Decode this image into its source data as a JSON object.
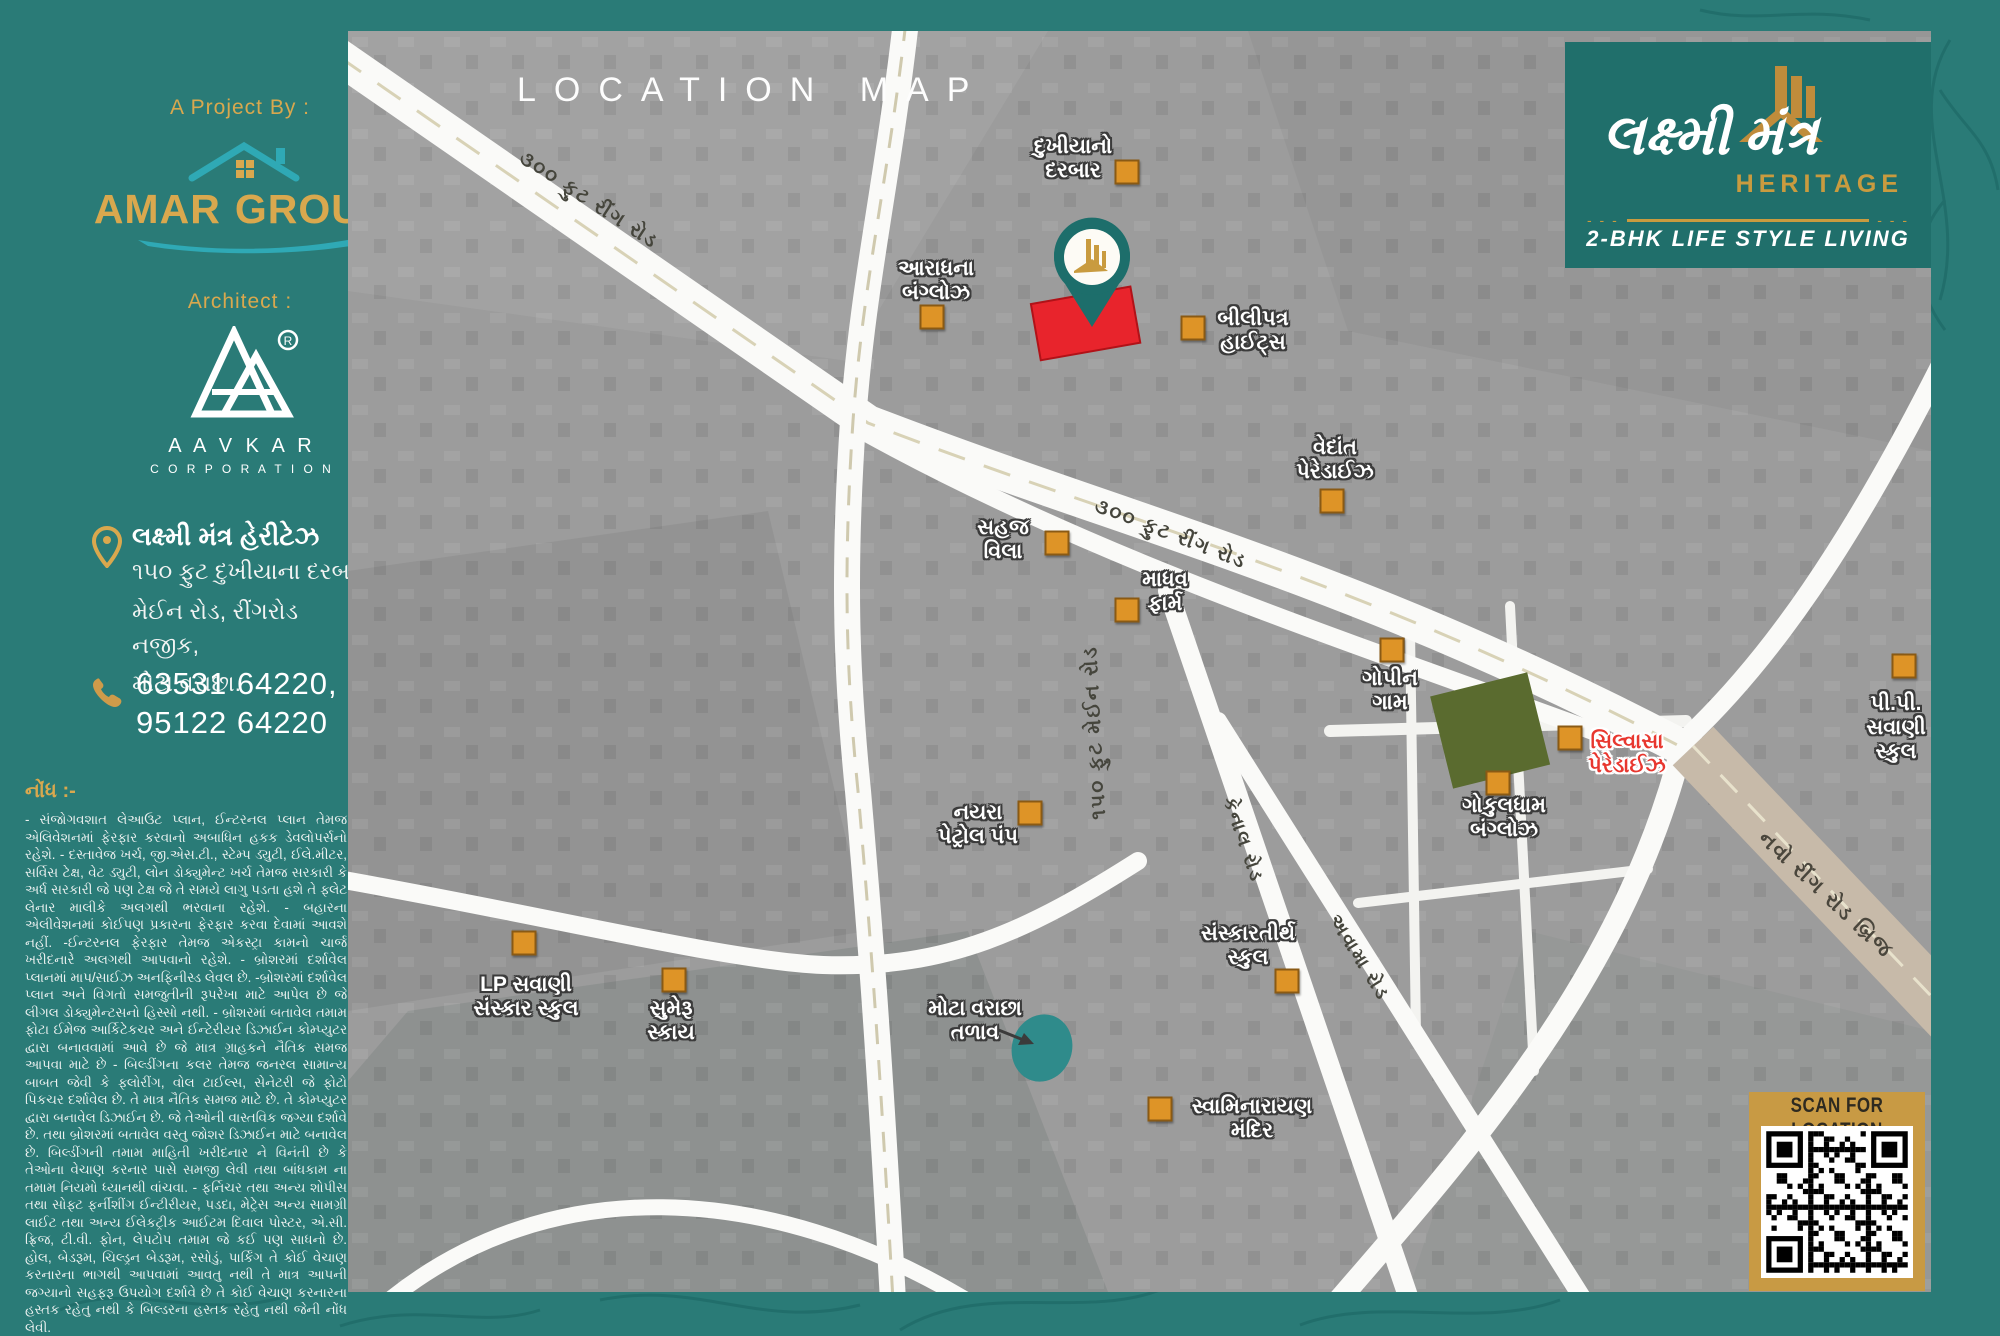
{
  "sidebar": {
    "project_by": "A Project By :",
    "amar": {
      "word1": "AMAR",
      "word2": "GROUP"
    },
    "architect": "Architect :",
    "aavkar": {
      "name": "A A V K A R",
      "sub": "C O R P O R A T I O N",
      "reg": "®"
    },
    "address": {
      "title": "લક્ષ્મી મંત્ર હેરીટેઝ",
      "line1": "૧૫૦ ફુટ દુખીયાના દરબાર",
      "line2": "મેઈન રોડ, રીંગરોડ નજીક,",
      "line3": "મોટા વરાછા."
    },
    "phone1": "63531 64220,",
    "phone2": "95122 64220",
    "note_heading": "નોંધ :-",
    "note_body": "- સંજોગવશાત લેઆઉટ પ્લાન, ઈન્ટરનલ પ્લાન તેમજ એલિવેશનમાં ફેરફાર કરવાનો અબાધિન હકક ડેવલોપર્સનો રહેશે. - દસ્તાવેજ ખર્ચ, જી.એસ.ટી., સ્ટેમ્પ ડ્યુટી, ઈલે.મીટર, સર્વિસ ટેક્ષ, વેટ ડ્યુટી, લોન ડોક્યુમેન્ટ ખર્ચ તેમજ સરકારી કે અર્ધ સરકારી જે પણ ટેક્ષ જે તે સમયે લાગુ પડતા હશે તે ફ્લેટ લેનાર માલીકે અલગથી ભરવાના રહેશે. - બહારના એલીવેશનમાં કોઈપણ પ્રકારના ફેરફાર કરવા દેવામાં આવશે નહીં. -ઈન્ટરનલ ફેરફાર તેમજ એકસ્ટ્રા કામનો ચાર્જ ખરીદનારે અલગથી આપવાનો રહેશે. - બ્રોશરમાં દર્શાવેલ પ્લાનમાં માપ/સાઈઝ અનફિનીસ્ડ લેવલ છે. -બ્રોશરમાં દર્શાવેલ પ્લાન અને વિગતો સમજુતીની રૂપરેખા માટે આપેલ છે જે લીગલ ડોક્યુમેન્ટસનો હિસ્સો નથી. - બ્રોશરમાં બતાવેલ તમામ ફોટા ઈમેજ આર્કિટેકચર અને ઈન્ટેરીયર ડિઝાઈન કોમ્પ્યુટર દ્વારા બનાવવામાં આવે છે જે માત્ર ગ્રાહકને નૈતિક સમજ આપવા માટે છે - બિલ્ડીંગના કલર તેમજ જનરલ સામાન્ય બાબત જેવી કે ફ્લોરીંગ, વોલ ટાઈલ્સ, સેનેટરી જે ફોટો પિકચર દર્શાવેલ છે. તે માત્ર નૈતિક સમજ માટે છે. તે કોમ્પ્યુટર દ્વારા બનાવેલ ડિઝાઈન છે. જે તેઓની વાસ્તવિક જગ્યા દર્શાવે છે. તથા બ્રોશરમાં બતાવેલ વસ્તુ જોશર ડિઝાઈન માટે બનાવેલ છે. બિલ્ડીંગની તમામ માહિતી ખરીદનાર ને વિનંતી છે કે તેઓના વેચાણ કરનાર પાસે સમજી લેવી તથા બાંધકામ ના તમામ નિયમો ધ્યાનથી વાંચવા. - ફર્નિચર તથા અન્ય શોપીસ તથા સોફ્ટ ફર્નીશીંગ ઈન્ટીરીયર, પડદા, મેટ્રેસ અન્ય સામગ્રી લાઈટ તથા અન્ય ઈલેકટ્રીક આઈટમ દિવાલ પોસ્ટર, એ.સી. ફ્રિજ, ટી.વી. ફોન, લેપટોપ તમામ જે કઈ પણ સાધનો છે. હોલ, બેડરૂમ, ચિલ્ડ્રન બેડરૂમ, રસોડું, પાર્કિંગ તે કોઈ વેચાણ કરનારના ભાગથી આપવામાં આવતુ નથી તે માત્ર આપની જગ્યાનો સહફરૂ ઉપયોગ દર્શાવે છે તે કોઈ વેચાણ કરનારના હસ્તક રહેતુ નથી કે બિલ્ડરના હસ્તક રહેતુ નથી જેની નોંધ લેવી."
  },
  "map": {
    "title": "LOCATION MAP",
    "brand": {
      "name": "લક્ષ્મી મંત્ર",
      "sub": "HERITAGE",
      "tagline": "2-BHK LIFE STYLE LIVING"
    },
    "qr_caption": "SCAN FOR LOCATION",
    "roads": {
      "ring300_a": "૩૦૦ ફુટ રીંગ રોડ",
      "ring300_b": "૩૦૦ ફુટ રીંગ રોડ",
      "main150": "૧૫૦ ફુટ મેઈન રોડ",
      "canal": "કેનાલ રોડ",
      "avama": "અવામા રોડ",
      "bridge": "નવો રીંગ રોડ બ્રિજ"
    },
    "places": {
      "dukhiyano": {
        "line1": "દુખીયાનો",
        "line2": "દરબાર"
      },
      "aradhana": {
        "line1": "આરાધના",
        "line2": "બંગ્લોઝ"
      },
      "bilipatra": {
        "line1": "બીલીપત્ર",
        "line2": "હાઈટ્સ"
      },
      "vedant": {
        "line1": "વેદાંત",
        "line2": "પેરેડાઈઝ"
      },
      "sahaj": {
        "line1": "સહજ",
        "line2": "વિલા"
      },
      "madhav": {
        "line1": "માધવ",
        "line2": "ફાર્મ"
      },
      "gopin": {
        "line1": "ગોપીન",
        "line2": "ગામ"
      },
      "pp_savani": {
        "line1": "પી.પી.",
        "line2": "સવાણી",
        "line3": "સ્કુલ"
      },
      "silvasa": {
        "line1": "સિલ્વાસા",
        "line2": "પેરેડાઈઝ"
      },
      "gokuldham": {
        "line1": "ગોકુલધામ",
        "line2": "બંગ્લોઝ"
      },
      "nayara": {
        "line1": "નયરા",
        "line2": "પેટ્રોલ પંપ"
      },
      "sanskartirth": {
        "line1": "સંસ્કારતીર્થ",
        "line2": "સ્કુલ"
      },
      "lp_savani": {
        "line1": "LP સવાણી",
        "line2": "સંસ્કાર સ્કુલ"
      },
      "sumeru": {
        "line1": "સુમેરૂ",
        "line2": "સ્કાય"
      },
      "talav": {
        "line1": "મોટા વરાછા",
        "line2": "તળાવ"
      },
      "swaminarayan": {
        "line1": "સ્વામિનારાયણ",
        "line2": "મંદિર"
      }
    }
  },
  "colors": {
    "teal_bg": "#2A7B77",
    "teal_dark": "#206F6B",
    "gold": "#D9A84E",
    "red_plot": "#E8242C",
    "green_plot": "#5A6B2F",
    "pond": "#2F8B8B",
    "marker_orange": "#DE9427",
    "road_white": "#FAFAF8"
  }
}
